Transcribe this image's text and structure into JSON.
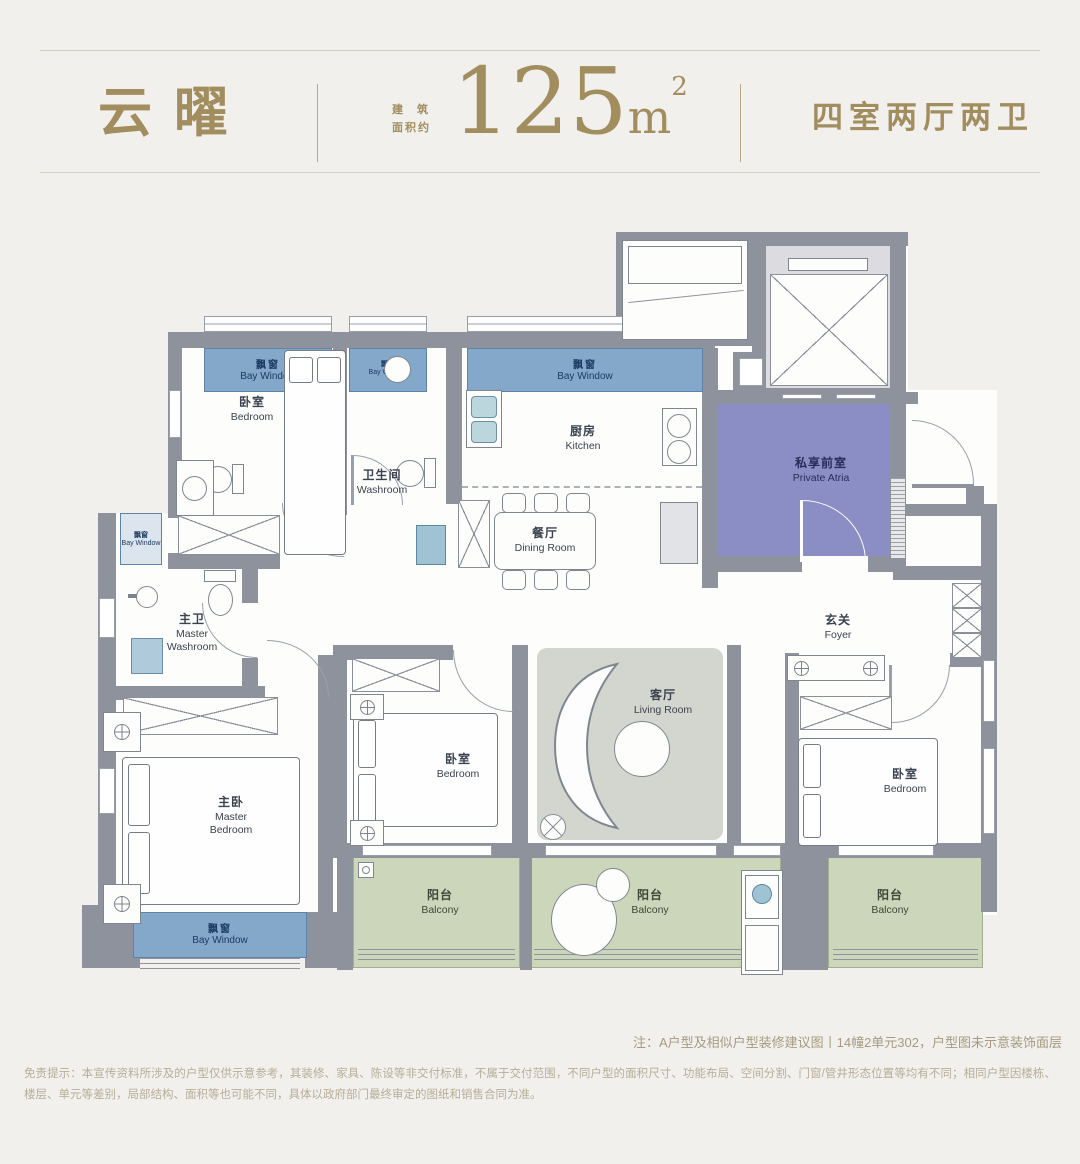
{
  "page": {
    "background": "#f1f0ec"
  },
  "header": {
    "title": "云曜",
    "area_prefix_line1": "建筑",
    "area_prefix_line2": "面积约",
    "area_value": "125",
    "area_unit": "m",
    "area_unit_sup": "2",
    "spec": "四室两厅两卫",
    "accent_color": "#a28d5f"
  },
  "plan": {
    "labels": {
      "bay_window": {
        "zh": "飘窗",
        "en": "Bay Window"
      },
      "bedroom": {
        "zh": "卧室",
        "en": "Bedroom"
      },
      "washroom": {
        "zh": "卫生间",
        "en": "Washroom"
      },
      "kitchen": {
        "zh": "厨房",
        "en": "Kitchen"
      },
      "dining_room": {
        "zh": "餐厅",
        "en": "Dining Room"
      },
      "private_atria": {
        "zh": "私享前室",
        "en": "Private Atria"
      },
      "master_washroom": {
        "zh": "主卫",
        "en": "Master Washroom"
      },
      "foyer": {
        "zh": "玄关",
        "en": "Foyer"
      },
      "master_bedroom": {
        "zh": "主卧",
        "en": "Master Bedroom"
      },
      "living_room": {
        "zh": "客厅",
        "en": "Living Room"
      },
      "balcony": {
        "zh": "阳台",
        "en": "Balcony"
      }
    },
    "colors": {
      "wall": "#8e929c",
      "bay_window_fill": "#84a8ca",
      "balcony_fill": "#ccd6ba",
      "atria_fill": "#8b8ec5",
      "living_rug": "#d3d6ce"
    }
  },
  "footer": {
    "note": "注：A户型及相似户型装修建议图丨14幢2单元302，户型图未示意装饰面层",
    "disclaimer": "免责提示：本宣传资料所涉及的户型仅供示意参考，其装修、家具、陈设等非交付标准，不属于交付范围，不同户型的面积尺寸、功能布局、空间分割、门窗/管井形态位置等均有不同；相同户型因楼栋、楼层、单元等差别，局部结构、面积等也可能不同，具体以政府部门最终审定的图纸和销售合同为准。"
  }
}
